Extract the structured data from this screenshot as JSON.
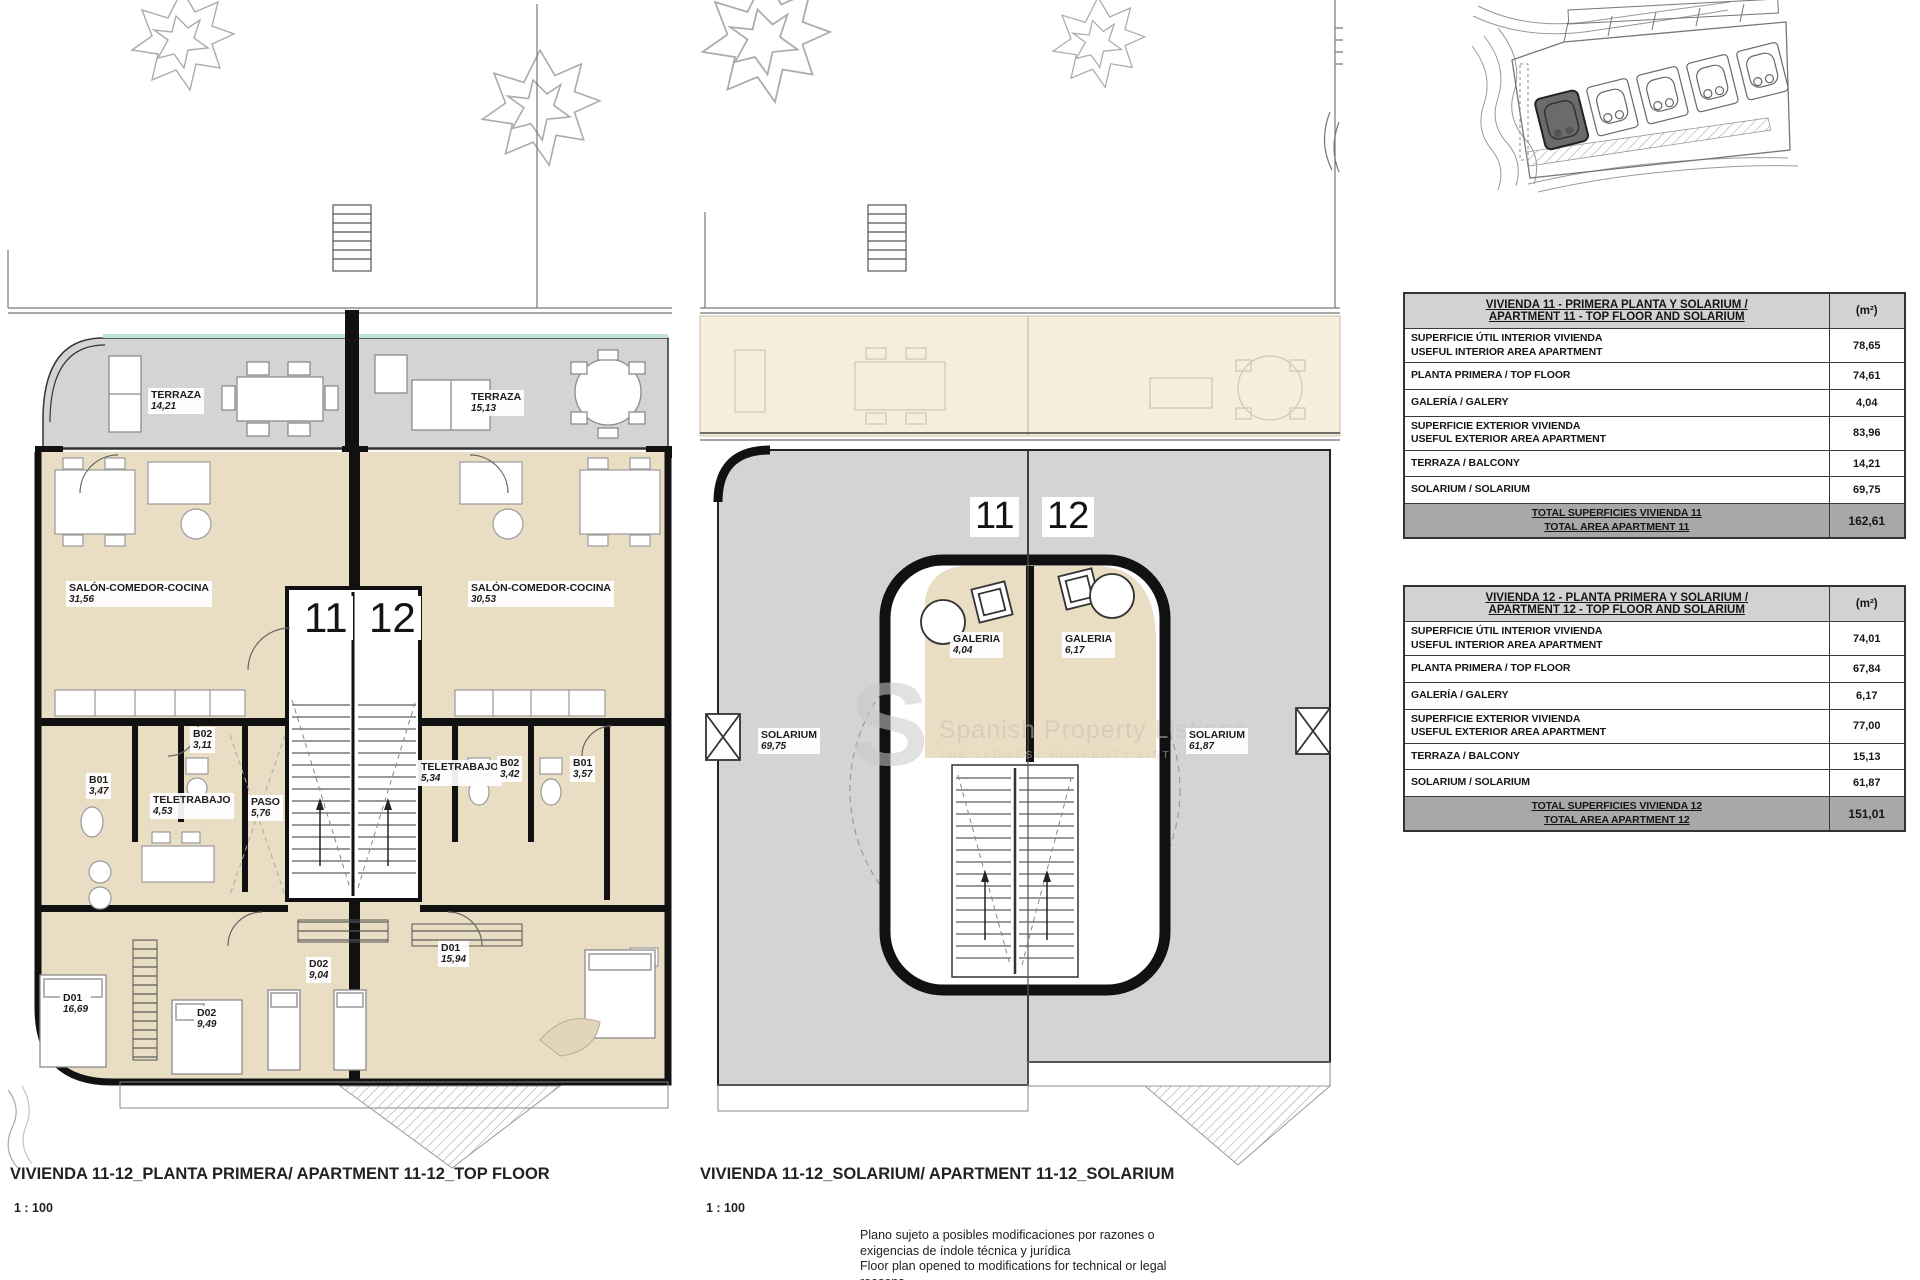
{
  "colors": {
    "room_fill": "#e9ddc4",
    "ghost_floor_fill": "#f6eedd",
    "terrace_fill": "#d4d4d4",
    "wall": "#111111",
    "glass_accent": "#bfe2df",
    "table_header_bg": "#d2d2d2",
    "table_total_bg": "#a8a8a8",
    "site_highlight": "#6b6b6b"
  },
  "watermark": {
    "letter": "S",
    "title": "Spanish Property Listings",
    "subtitle": "THE LARGEST PROPERTY LISTING"
  },
  "plans": [
    {
      "caption": "VIVIENDA 11-12_PLANTA PRIMERA/ APARTMENT 11-12_TOP FLOOR",
      "scale": "1 : 100",
      "units": [
        "11",
        "12"
      ],
      "rooms": [
        {
          "name": "TERRAZA",
          "area": "14,21"
        },
        {
          "name": "TERRAZA",
          "area": "15,13"
        },
        {
          "name": "SALÓN-COMEDOR-COCINA",
          "area": "31,56"
        },
        {
          "name": "SALÓN-COMEDOR-COCINA",
          "area": "30,53"
        },
        {
          "name": "B02",
          "area": "3,11"
        },
        {
          "name": "B01",
          "area": "3,47"
        },
        {
          "name": "TELETRABAJO",
          "area": "4,53"
        },
        {
          "name": "PASO",
          "area": "5,76"
        },
        {
          "name": "TELETRABAJO",
          "area": "5,34"
        },
        {
          "name": "B02",
          "area": "3,42"
        },
        {
          "name": "B01",
          "area": "3,57"
        },
        {
          "name": "D01",
          "area": "16,69"
        },
        {
          "name": "D02",
          "area": "9,49"
        },
        {
          "name": "D02",
          "area": "9,04"
        },
        {
          "name": "D01",
          "area": "15,94"
        }
      ]
    },
    {
      "caption": "VIVIENDA 11-12_SOLARIUM/ APARTMENT 11-12_SOLARIUM",
      "scale": "1 : 100",
      "units": [
        "11",
        "12"
      ],
      "rooms": [
        {
          "name": "GALERIA",
          "area": "4,04"
        },
        {
          "name": "GALERIA",
          "area": "6,17"
        },
        {
          "name": "SOLARIUM",
          "area": "69,75"
        },
        {
          "name": "SOLARIUM",
          "area": "61,87"
        }
      ]
    }
  ],
  "tables": [
    {
      "title_line1": "VIVIENDA 11 - PRIMERA PLANTA Y SOLARIUM /",
      "title_line2": "APARTMENT 11 - TOP FLOOR AND SOLARIUM",
      "unit": "(m²)",
      "rows": [
        {
          "label1": "SUPERFICIE ÚTIL INTERIOR VIVIENDA",
          "label2": "USEFUL INTERIOR AREA APARTMENT",
          "value": "78,65"
        },
        {
          "label1": "PLANTA PRIMERA / TOP FLOOR",
          "label2": "",
          "value": "74,61"
        },
        {
          "label1": "GALERÍA / GALERY",
          "label2": "",
          "value": "4,04"
        },
        {
          "label1": "SUPERFICIE EXTERIOR VIVIENDA",
          "label2": "USEFUL EXTERIOR AREA APARTMENT",
          "value": "83,96"
        },
        {
          "label1": "TERRAZA / BALCONY",
          "label2": "",
          "value": "14,21"
        },
        {
          "label1": "SOLARIUM / SOLARIUM",
          "label2": "",
          "value": "69,75"
        }
      ],
      "total_line1": "TOTAL SUPERFICIES VIVIENDA 11",
      "total_line2": "TOTAL AREA APARTMENT 11",
      "total_value": "162,61"
    },
    {
      "title_line1": "VIVIENDA 12 - PLANTA PRIMERA Y SOLARIUM /",
      "title_line2": "APARTMENT 12 - TOP FLOOR AND SOLARIUM",
      "unit": "(m²)",
      "rows": [
        {
          "label1": "SUPERFICIE ÚTIL INTERIOR VIVIENDA",
          "label2": "USEFUL INTERIOR AREA APARTMENT",
          "value": "74,01"
        },
        {
          "label1": "PLANTA PRIMERA / TOP FLOOR",
          "label2": "",
          "value": "67,84"
        },
        {
          "label1": "GALERÍA / GALERY",
          "label2": "",
          "value": "6,17"
        },
        {
          "label1": "SUPERFICIE EXTERIOR VIVIENDA",
          "label2": "USEFUL EXTERIOR AREA APARTMENT",
          "value": "77,00"
        },
        {
          "label1": "TERRAZA / BALCONY",
          "label2": "",
          "value": "15,13"
        },
        {
          "label1": "SOLARIUM / SOLARIUM",
          "label2": "",
          "value": "61,87"
        }
      ],
      "total_line1": "TOTAL SUPERFICIES VIVIENDA 12",
      "total_line2": "TOTAL AREA APARTMENT 12",
      "total_value": "151,01"
    }
  ],
  "disclaimer": [
    "Plano sujeto a posibles modificaciones por razones o",
    "exigencias de índole técnica y jurídica",
    "Floor plan opened to modifications for technical or legal",
    "reasons"
  ]
}
